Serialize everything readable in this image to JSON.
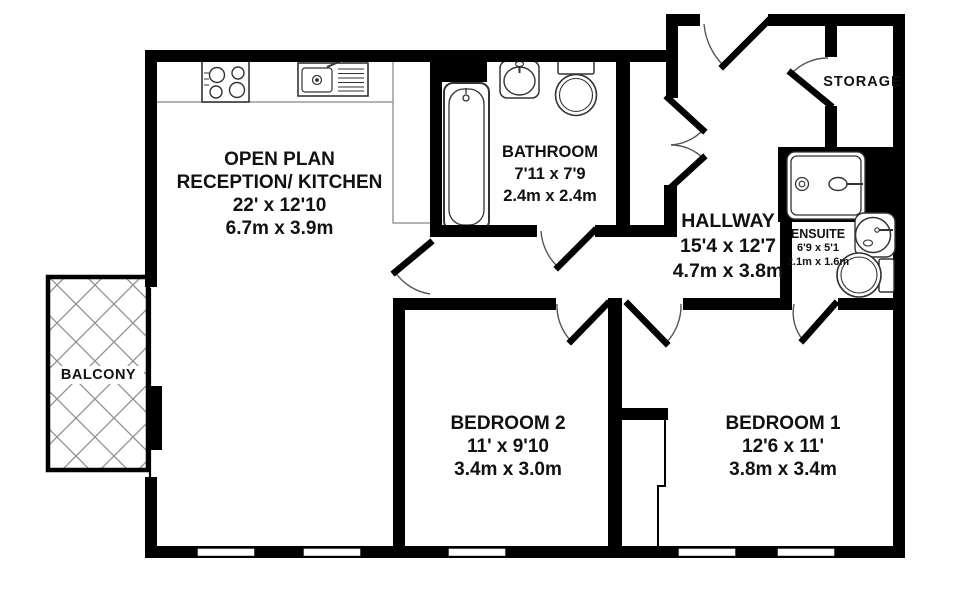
{
  "plan": {
    "title": "2 bedroom apartment floor plan",
    "rooms": [
      {
        "id": "reception",
        "label_line1": "OPEN PLAN",
        "label_line2": "RECEPTION/ KITCHEN",
        "size_imperial": "22' x 12'10",
        "size_metric": "6.7m x 3.9m"
      },
      {
        "id": "bathroom",
        "label_line1": "BATHROOM",
        "size_imperial": "7'11 x 7'9",
        "size_metric": "2.4m x 2.4m"
      },
      {
        "id": "hallway",
        "label_line1": "HALLWAY",
        "size_imperial": "15'4 x 12'7",
        "size_metric": "4.7m x 3.8m"
      },
      {
        "id": "storage",
        "label_line1": "STORAGE"
      },
      {
        "id": "ensuite",
        "label_line1": "ENSUITE",
        "size_imperial": "6'9 x 5'1",
        "size_metric": "2.1m x 1.6m"
      },
      {
        "id": "bedroom2",
        "label_line1": "BEDROOM 2",
        "size_imperial": "11' x 9'10",
        "size_metric": "3.4m x 3.0m"
      },
      {
        "id": "bedroom1",
        "label_line1": "BEDROOM 1",
        "size_imperial": "12'6 x 11'",
        "size_metric": "3.8m x 3.4m"
      },
      {
        "id": "balcony",
        "label_line1": "BALCONY"
      }
    ],
    "icons": {
      "kitchen": [
        "stove-icon",
        "kitchen-sink-icon"
      ],
      "bathroom": [
        "bathtub-icon",
        "basin-icon",
        "toilet-icon"
      ],
      "ensuite": [
        "shower-icon",
        "basin-icon",
        "toilet-icon"
      ]
    },
    "colors": {
      "wall": "#000000",
      "hatch": "#8f8f8f",
      "door_arc": "#555555",
      "fixture": "#333333",
      "counter": "#9a9a9a",
      "text": "#111111"
    }
  }
}
